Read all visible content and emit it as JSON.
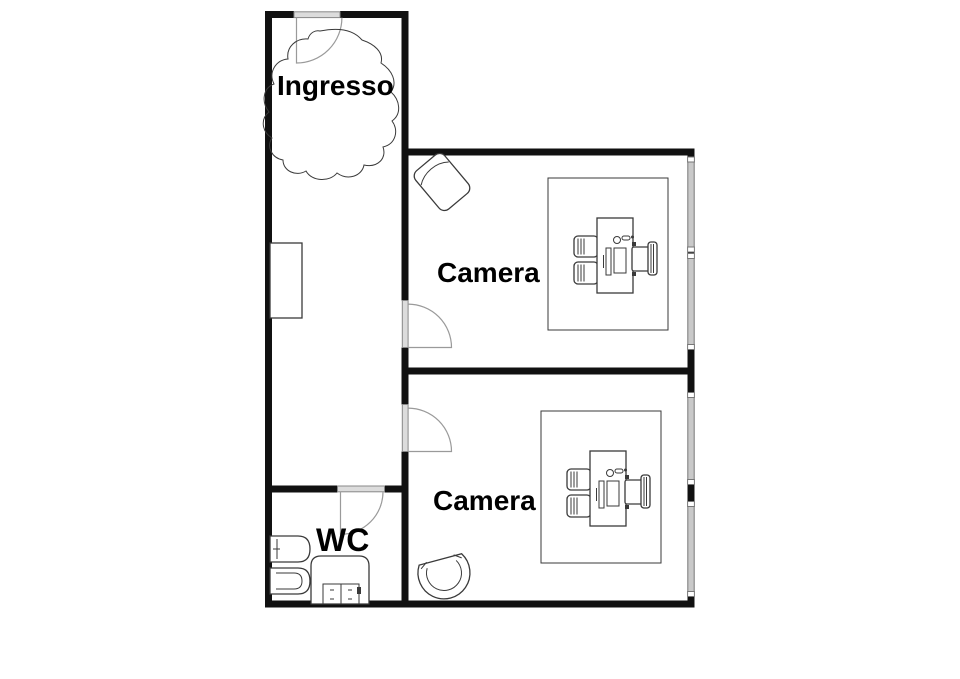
{
  "plan": {
    "title": "Apartment floor plan",
    "rooms": [
      {
        "id": "ingresso",
        "label": "Ingresso"
      },
      {
        "id": "camera-1",
        "label": "Camera"
      },
      {
        "id": "camera-2",
        "label": "Camera"
      },
      {
        "id": "wc",
        "label": "WC"
      }
    ],
    "furniture_icons": [
      "entrance-door-icon",
      "rug-blob-icon",
      "wardrobe-icon",
      "door-icon-camera-1",
      "door-icon-camera-2",
      "door-icon-wc",
      "armchair-icon",
      "desk-set-icon",
      "desk-set-icon",
      "tub-chair-icon",
      "toilet-icon",
      "bidet-icon",
      "shower-icon",
      "window-icon",
      "window-icon",
      "window-icon",
      "window-icon"
    ],
    "colors": {
      "wall": "#111111",
      "window": "#c9c9c9",
      "door": "#dcdcdc",
      "line": "#3a3a3a",
      "text": "#000000",
      "background": "#ffffff"
    }
  }
}
